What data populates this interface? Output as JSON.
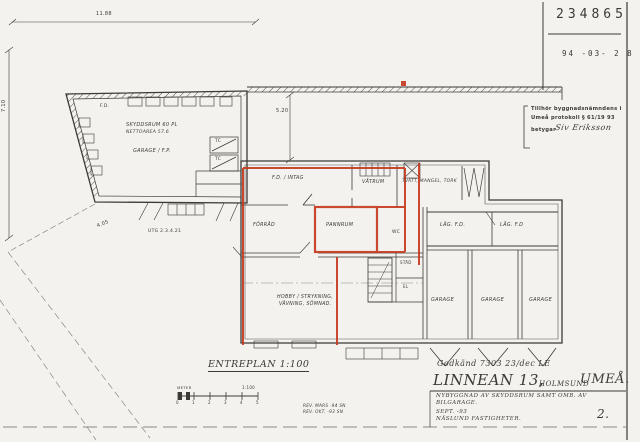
{
  "colors": {
    "paper": "#f3f2ef",
    "ink": "#3c3a35",
    "red_marking": "#c73a1d",
    "faint": "#8a8880"
  },
  "stamp_box": {
    "number": "234865",
    "date": "94 -03- 2 8"
  },
  "approval_stamp": {
    "line1": "Tillhör byggnadsnämndens i",
    "line2": "Umeå protokoll § 61/19 93",
    "betygar_label": "betygar",
    "signature": "Siv Eriksson"
  },
  "dimensions": {
    "top_width": "11.88",
    "left_height": "7.10",
    "boundary": "4.05",
    "courtyard": "5.20",
    "exit_note": "UTG 2.3.4.21"
  },
  "shelter_building": {
    "fd": "F.D.",
    "name": "SKYDDSRUM 60 PL",
    "net_area": "NETTOAREA 57.6",
    "garage": "GARAGE / F.P.",
    "tc_a": "TC",
    "tc_b": "TC"
  },
  "main_building": {
    "fd_intag": "F.D. / INTAG",
    "vatrum": "VÅTRUM",
    "laundry": "TVÄTT, MANGEL, TORK",
    "forrad": "FÖRRÅD",
    "pannrum": "PANNRUM",
    "wc": "WC",
    "stad": "STÄD",
    "el": "EL",
    "lag_fd_1": "LÄG. F.D.",
    "lag_fd_2": "LÄG. F.D",
    "hobby_line1": "HOBBY / STRYKNING,",
    "hobby_line2": "VÄVNING, SÖMNAD.",
    "garage_1": "GARAGE",
    "garage_2": "GARAGE",
    "garage_3": "GARAGE"
  },
  "plan": {
    "title": "ENTREPLAN 1:100",
    "scale_unit": "METER",
    "scale_ratio": "1:100",
    "scale_ticks": [
      "0",
      "1",
      "2",
      "3",
      "4",
      "5"
    ]
  },
  "revisions": {
    "line1": "REV. MARS -94 SN",
    "line2": "REV. OKT. -93 SN"
  },
  "title_block": {
    "approval": "Godkänd 7303 23/dec LE",
    "property": "LINNEAN 13,",
    "district": "HOLMSUND",
    "city": "UMEÅ.",
    "project_line1": "NYBYGGNAD AV SKYDDSRUM SAMT OMB. AV",
    "project_line2": "BILGARAGE.",
    "date": "SEPT. -93",
    "client": "NÄSLUND FASTIGHETER.",
    "sheet_no": "2."
  }
}
